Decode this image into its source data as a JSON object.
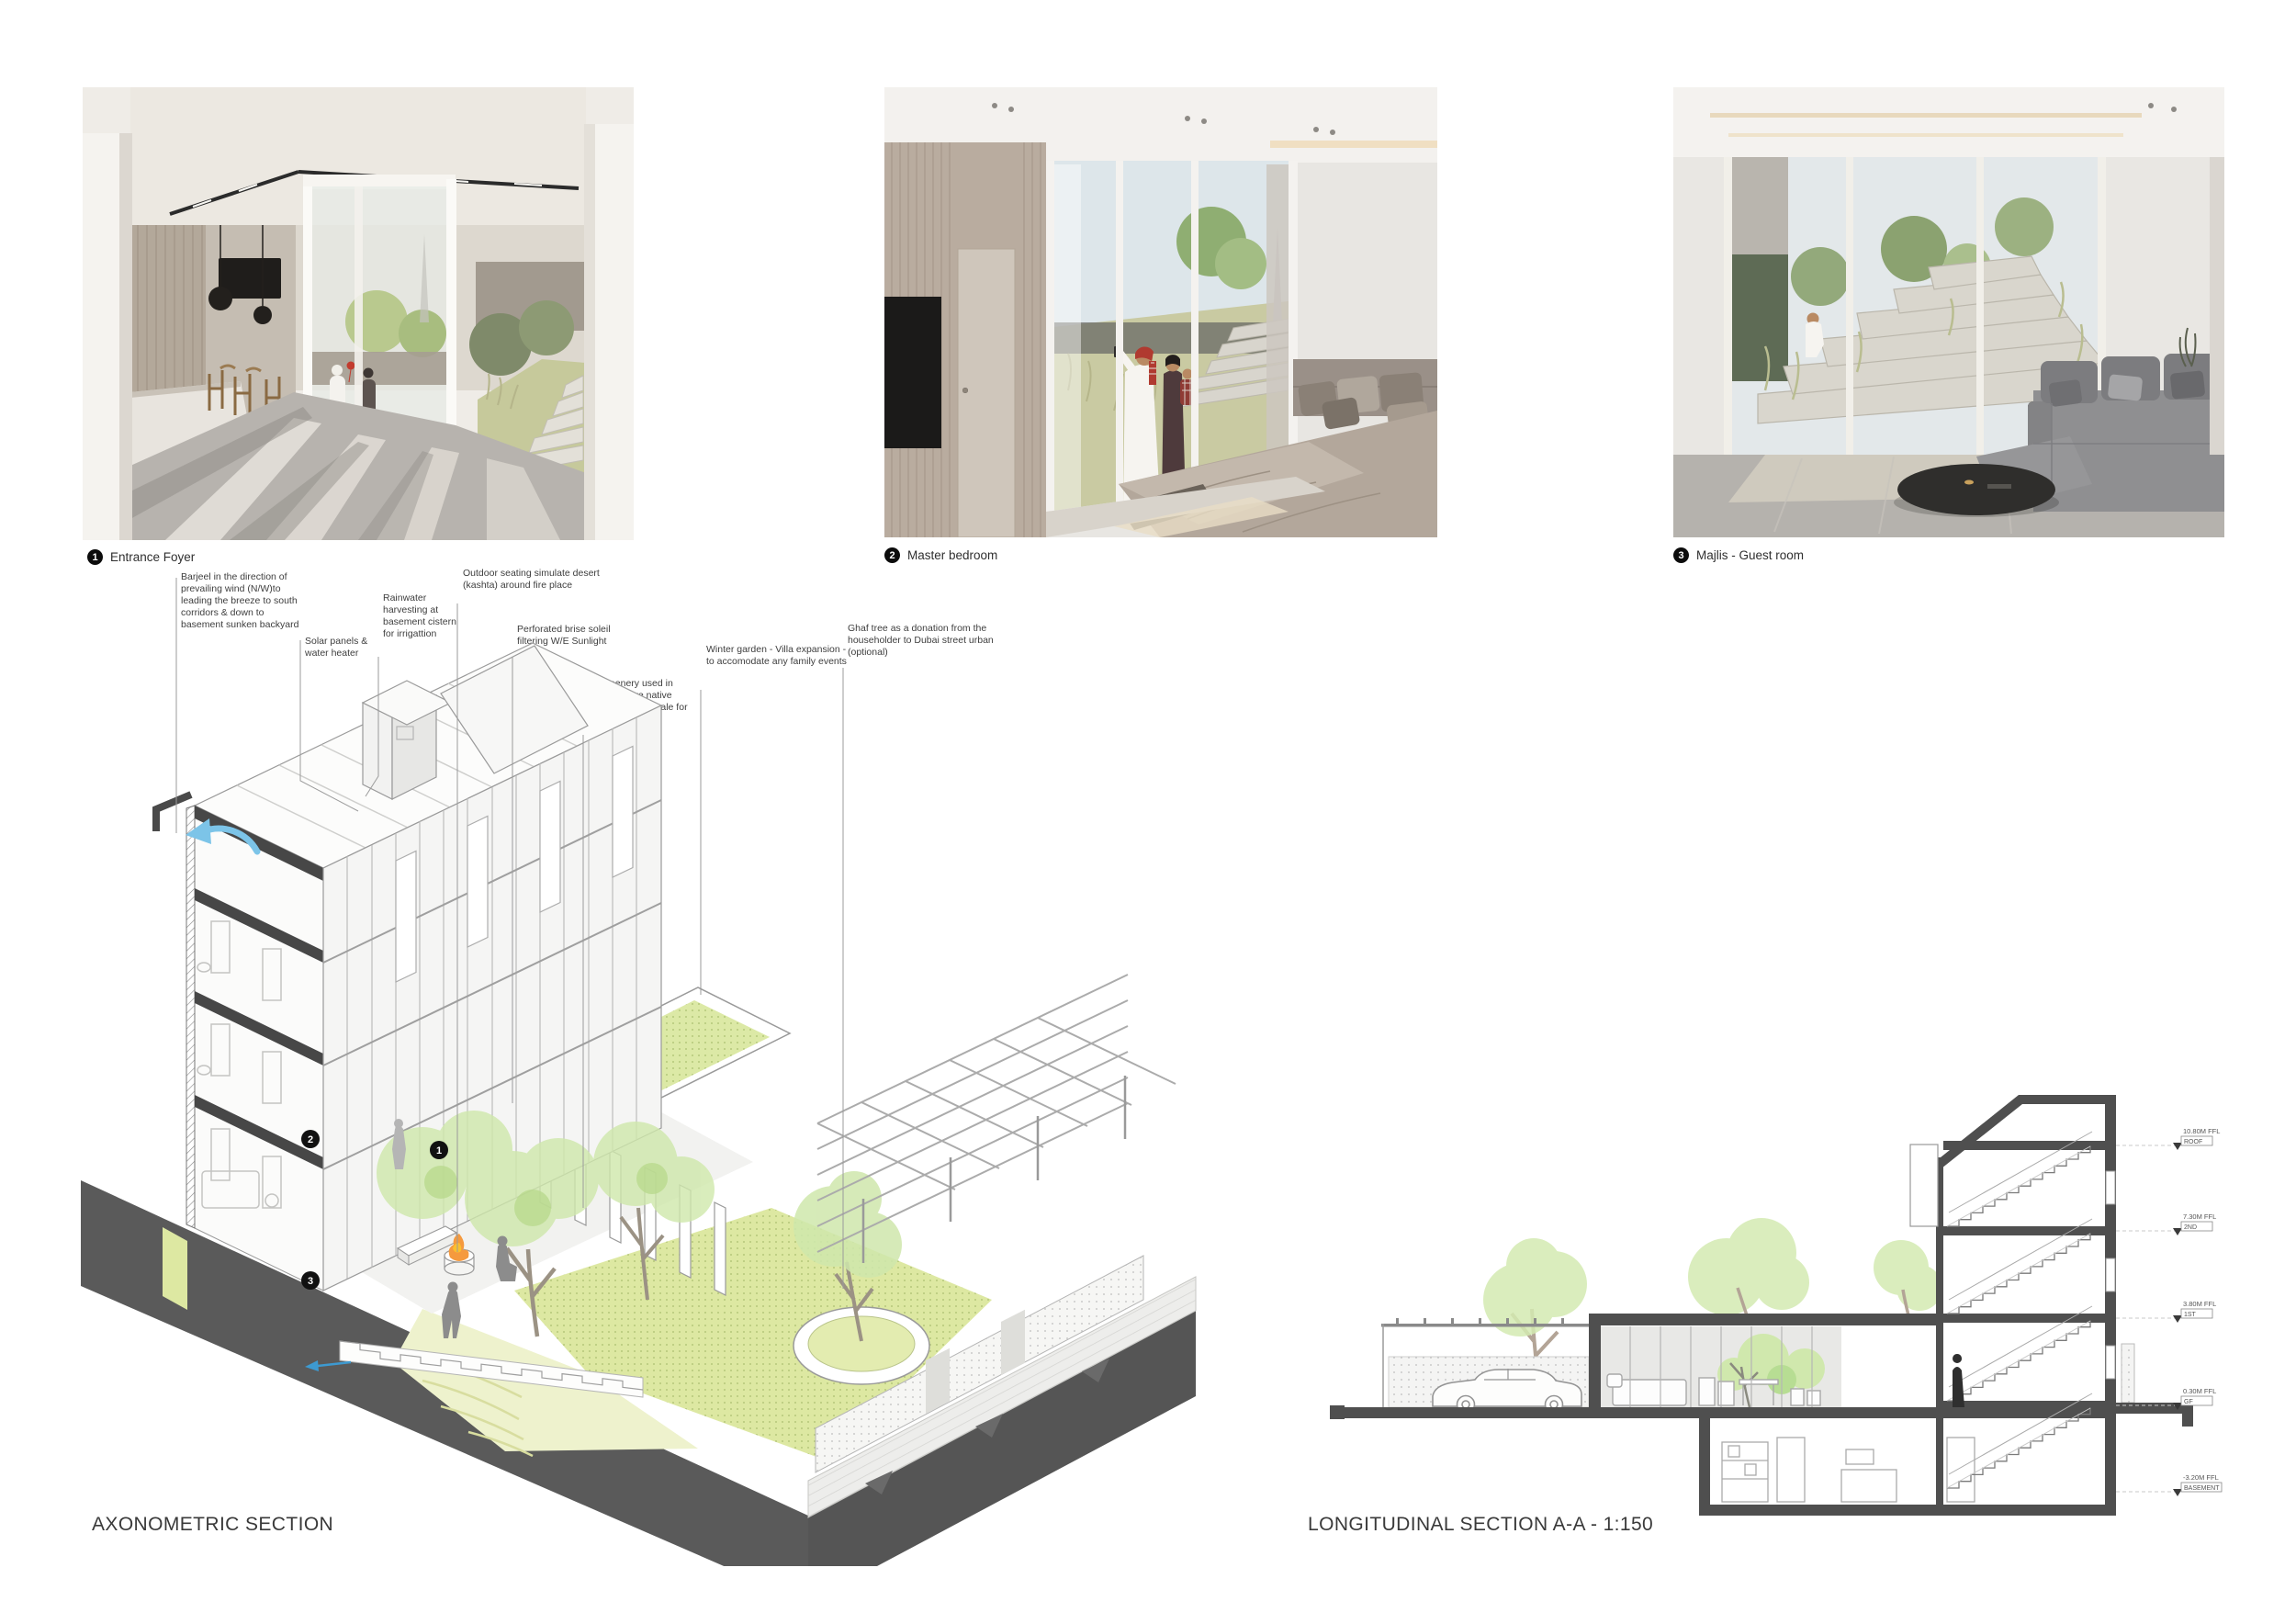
{
  "photos": [
    {
      "number": "1",
      "label": "Entrance Foyer"
    },
    {
      "number": "2",
      "label": "Master bedroom"
    },
    {
      "number": "3",
      "label": "Majlis - Guest room"
    }
  ],
  "axonometric": {
    "title": "AXONOMETRIC SECTION",
    "annotations": [
      {
        "text": "Barjeel in the direction of prevailing wind (N/W)to leading the breeze to south corridors & down to basement sunken backyard"
      },
      {
        "text": "Solar panels & water heater"
      },
      {
        "text": "Rainwater harvesting at basement cistern for irrigattion"
      },
      {
        "text": "Outdoor seating simulate desert (kashta) around fire place"
      },
      {
        "text": "Perforated brise soleil filtering W/E Sunlight"
      },
      {
        "text": "All greenery used in BARAHA are native plants and Bioswale for Xeriscaping"
      },
      {
        "text": "Winter garden - Villa expansion - to accomodate any family events"
      },
      {
        "text": "Ghaf tree as a donation from the householder to Dubai street urban (optional)"
      }
    ],
    "markers": [
      "1",
      "2",
      "3"
    ]
  },
  "longitudinal": {
    "title": "LONGITUDINAL SECTION A-A - 1:150",
    "levels": [
      {
        "elevation": "10.80M FFL",
        "name": "ROOF"
      },
      {
        "elevation": "7.30M FFL",
        "name": "2ND"
      },
      {
        "elevation": "3.80M FFL",
        "name": "1ST"
      },
      {
        "elevation": "0.30M FFL",
        "name": "GF"
      },
      {
        "elevation": "-3.20M FFL",
        "name": "BASEMENT"
      }
    ]
  },
  "colors": {
    "cut_dark": "#4a4a4a",
    "plinth": "#5a5a5a",
    "greenery": "#cfe8ab",
    "lawn": "#dde8a2",
    "wind_blue": "#7cc4e8",
    "fire_orange": "#f59a3e"
  }
}
